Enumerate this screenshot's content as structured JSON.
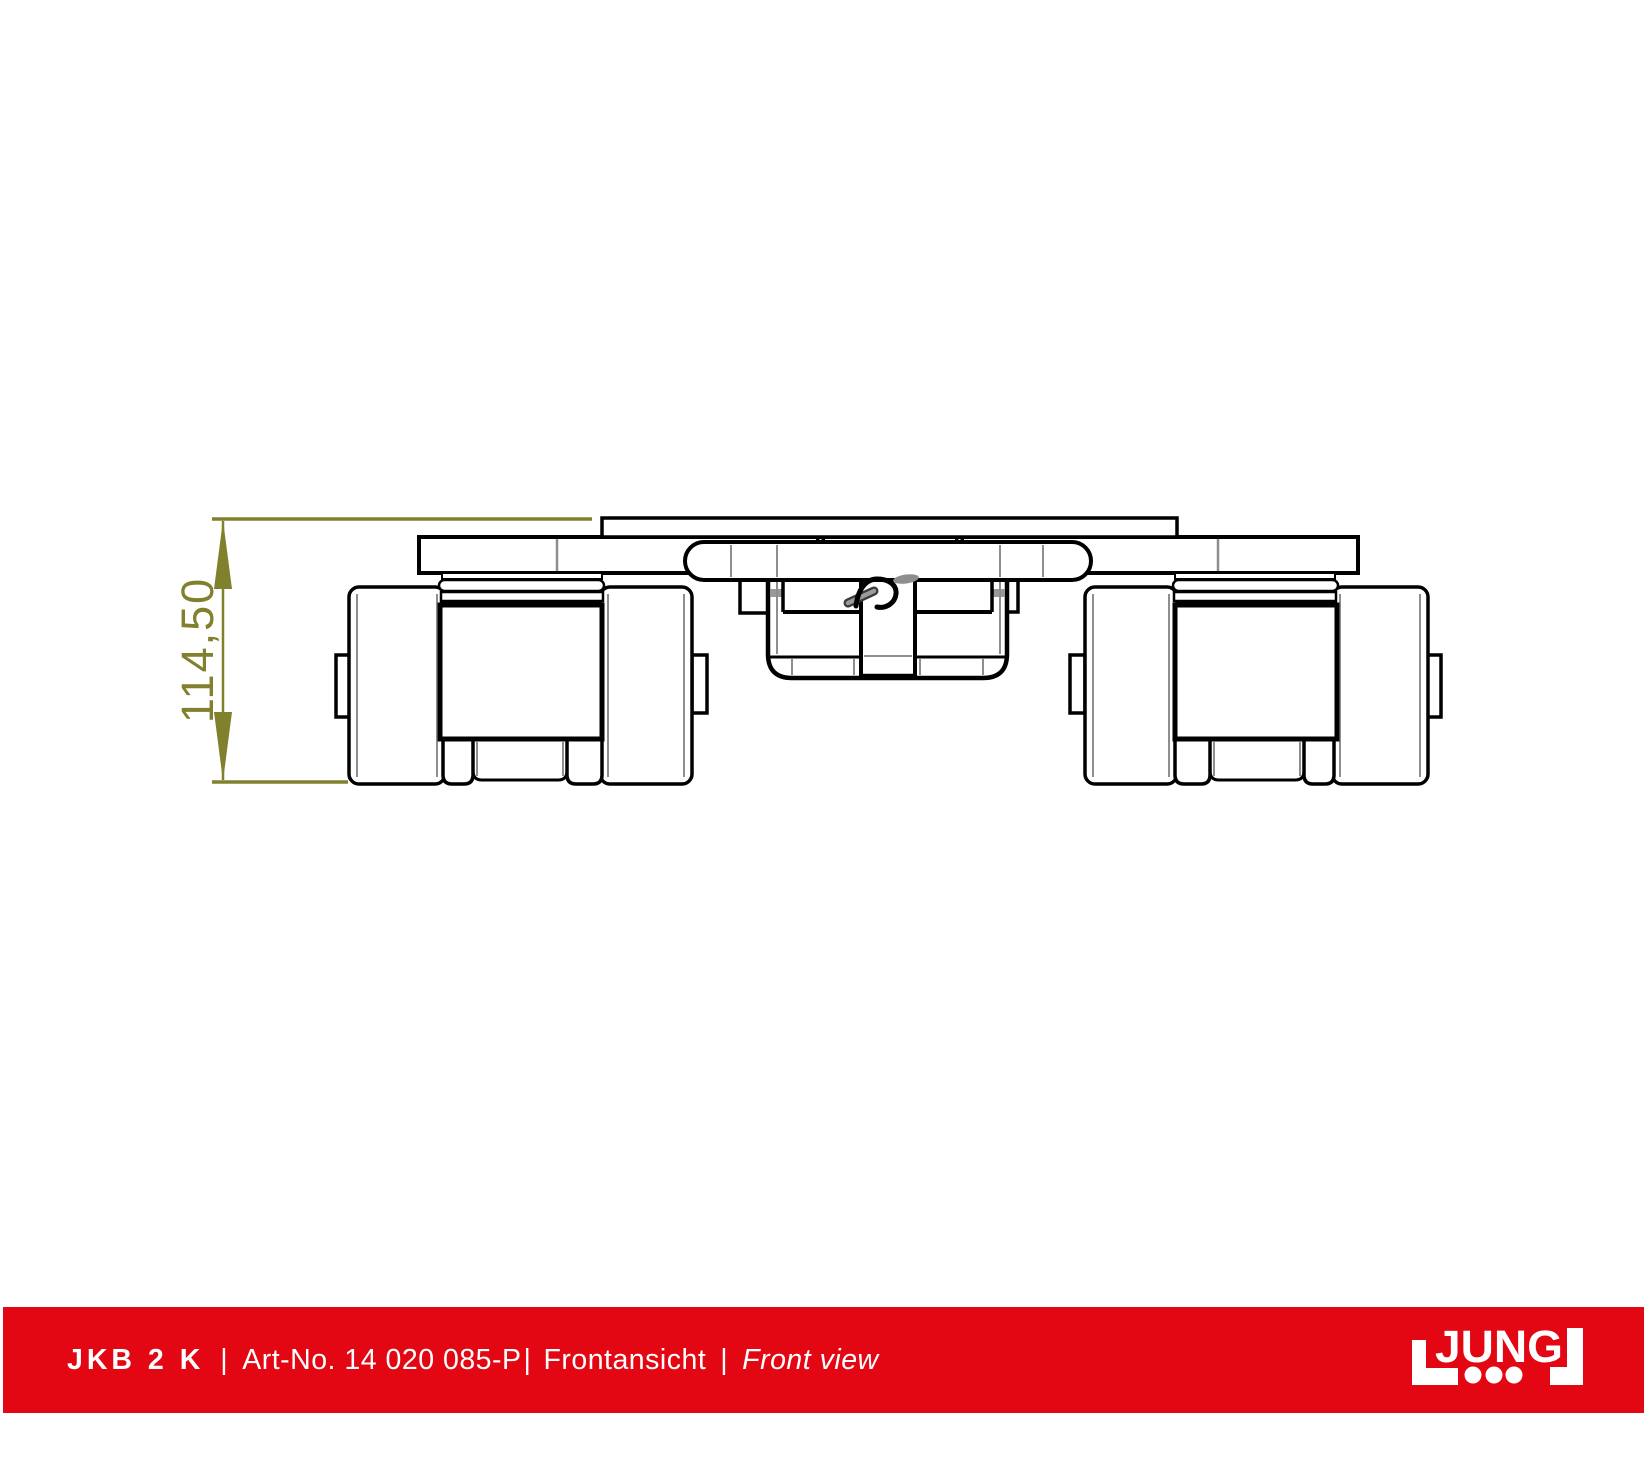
{
  "page": {
    "width_px": 1649,
    "height_px": 1464,
    "background": "#ffffff"
  },
  "drawing": {
    "view": "front",
    "line_color": "#000000",
    "secondary_line_color": "#8e8e8e",
    "fill_color": "#ffffff"
  },
  "dimension": {
    "value": "114,50",
    "color": "#80802d"
  },
  "footer": {
    "bar_color": "#e30613",
    "text_color": "#ffffff",
    "model": "JKB 2 K",
    "sep1": "|",
    "art_no": "Art-No. 14 020 085-P",
    "sep2": "|",
    "view_de": "Frontansicht",
    "sep3": "|",
    "view_en": "Front view"
  },
  "logo": {
    "brand": "JUNG",
    "color": "#ffffff"
  }
}
